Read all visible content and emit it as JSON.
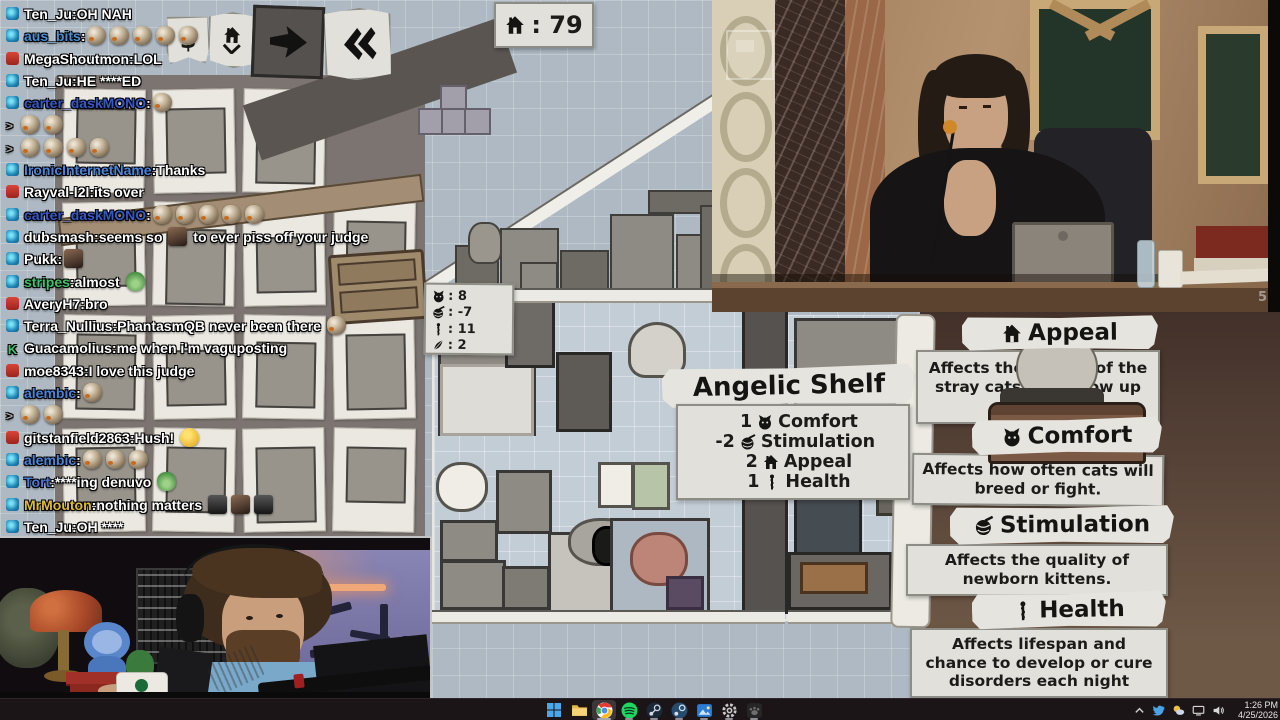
{
  "chat": {
    "continuation_prefix": ">",
    "separator": ":",
    "messages": [
      {
        "badge": "sub",
        "user": "Ten_Ju",
        "color": "#ffffff",
        "parts": [
          {
            "text": "OH NAH"
          }
        ]
      },
      {
        "badge": "sub",
        "user": "aus_bits",
        "color": "#4a90d8",
        "parts": [
          {
            "emote": "bird",
            "count": 5
          }
        ]
      },
      {
        "badge": "mod-red",
        "user": "MegaShoutmon",
        "color": "#ffffff",
        "parts": [
          {
            "text": "LOL"
          }
        ]
      },
      {
        "badge": "sub",
        "user": "Ten_Ju",
        "color": "#ffffff",
        "parts": [
          {
            "text": "HE ****ED"
          }
        ]
      },
      {
        "badge": "sub",
        "user": "carter_daskMONO",
        "color": "#3558c8",
        "parts": [
          {
            "emote": "bird",
            "count": 1
          }
        ]
      },
      {
        "cont": true,
        "parts": [
          {
            "emote": "bird",
            "count": 2
          }
        ]
      },
      {
        "cont": true,
        "parts": [
          {
            "emote": "bird",
            "count": 4
          }
        ]
      },
      {
        "badge": "sub",
        "user": "IronicInternetName",
        "color": "#4a85dc",
        "parts": [
          {
            "text": "Thanks"
          }
        ]
      },
      {
        "badge": "mod-red",
        "user": "Rayval-l2l",
        "color": "#ffffff",
        "parts": [
          {
            "text": "its over"
          }
        ]
      },
      {
        "badge": "sub",
        "user": "carter_daskMONO",
        "color": "#3558c8",
        "parts": [
          {
            "emote": "bird",
            "count": 5
          }
        ]
      },
      {
        "badge": "sub",
        "user": "dubsmash",
        "color": "#ffffff",
        "parts": [
          {
            "text": "seems so "
          },
          {
            "emote": "photo",
            "count": 1
          },
          {
            "text": " to ever piss off your judge"
          }
        ]
      },
      {
        "badge": "sub",
        "user": "Pukk",
        "color": "#ffffff",
        "parts": [
          {
            "emote": "photo",
            "count": 1
          }
        ]
      },
      {
        "badge": "sub",
        "user": "stripes",
        "color": "#3bc46a",
        "parts": [
          {
            "text": "almost "
          },
          {
            "emote": "frog",
            "count": 1
          }
        ]
      },
      {
        "badge": "mod-red",
        "user": "AveryH7",
        "color": "#ffffff",
        "parts": [
          {
            "text": "bro"
          }
        ]
      },
      {
        "badge": "sub",
        "user": "Terra_Nullius",
        "color": "#ffffff",
        "parts": [
          {
            "text": "PhantasmQB never been there "
          },
          {
            "emote": "bird",
            "count": 1
          }
        ]
      },
      {
        "badge": "founder",
        "user": "Guacamolius",
        "color": "#ffffff",
        "parts": [
          {
            "text": "me when i'm vaguposting"
          }
        ]
      },
      {
        "badge": "mod-red",
        "user": "moe8343",
        "color": "#ffffff",
        "parts": [
          {
            "text": "I love this judge"
          }
        ]
      },
      {
        "badge": "sub",
        "user": "alembic",
        "color": "#4a85dc",
        "parts": [
          {
            "emote": "bird",
            "count": 1
          }
        ]
      },
      {
        "cont": true,
        "parts": [
          {
            "emote": "bird",
            "count": 2
          }
        ]
      },
      {
        "badge": "mod-red",
        "user": "gitstanfield2863",
        "color": "#ffffff",
        "parts": [
          {
            "text": "Hush! "
          },
          {
            "emote": "hush",
            "count": 1
          }
        ]
      },
      {
        "badge": "sub",
        "user": "alembic",
        "color": "#4a85dc",
        "parts": [
          {
            "emote": "bird",
            "count": 3
          }
        ]
      },
      {
        "badge": "sub",
        "user": "Tort",
        "color": "#4a78d8",
        "parts": [
          {
            "text": "****ing denuvo "
          },
          {
            "emote": "frog",
            "count": 1
          }
        ]
      },
      {
        "badge": "sub",
        "user": "MrMouton",
        "color": "#e0bc30",
        "parts": [
          {
            "text": "nothing matters "
          },
          {
            "emote": "dark",
            "count": 1
          },
          {
            "emote": "photo",
            "count": 1
          },
          {
            "emote": "dark",
            "count": 1
          }
        ]
      },
      {
        "badge": "sub",
        "user": "Ten_Ju",
        "color": "#ffffff",
        "parts": [
          {
            "text": "OH ****"
          }
        ]
      }
    ]
  },
  "game": {
    "appeal_counter": {
      "icon": "house",
      "sep": ":",
      "value": "79"
    },
    "toolbar": [
      {
        "name": "money-button",
        "glyph": "$"
      },
      {
        "name": "house-down-button"
      },
      {
        "name": "fast-forward-button"
      },
      {
        "name": "rewind-button",
        "glyph": "«"
      }
    ],
    "stats_panel": {
      "sep": ":",
      "rows": [
        {
          "icon": "cat",
          "value": "8"
        },
        {
          "icon": "yarn",
          "value": "-7"
        },
        {
          "icon": "health",
          "value": "11"
        },
        {
          "icon": "feather",
          "value": "2"
        }
      ]
    },
    "tooltip": {
      "title": "Angelic Shelf",
      "stats": [
        {
          "value": "1",
          "icon": "cat",
          "label": "Comfort"
        },
        {
          "value": "-2",
          "icon": "yarn",
          "label": "Stimulation"
        },
        {
          "value": "2",
          "icon": "house",
          "label": "Appeal"
        },
        {
          "value": "1",
          "icon": "health",
          "label": "Health"
        }
      ]
    },
    "avatar_label": "MrMouton",
    "info_panels": [
      {
        "icon": "house",
        "title": "Appeal",
        "desc": "Affects the quality of the stray cats that show up each day"
      },
      {
        "icon": "cat",
        "title": "Comfort",
        "desc": "Affects how often cats will breed or fight."
      },
      {
        "icon": "yarn",
        "title": "Stimulation",
        "desc": "Affects the quality of newborn kittens."
      },
      {
        "icon": "health",
        "title": "Health",
        "desc": "Affects lifespan and chance to develop or cure disorders each night"
      }
    ]
  },
  "judge_cam": {
    "watermark": "5"
  },
  "taskbar": {
    "icons": [
      {
        "name": "start"
      },
      {
        "name": "file-explorer"
      },
      {
        "name": "chrome",
        "active": true,
        "running": true
      },
      {
        "name": "spotify",
        "running": true
      },
      {
        "name": "steam",
        "running": true
      },
      {
        "name": "steam-2",
        "running": true
      },
      {
        "name": "photos",
        "running": true
      },
      {
        "name": "settings",
        "running": true
      },
      {
        "name": "paw-app",
        "running": true
      }
    ],
    "tray": {
      "icons": [
        "tray-expand-chevron",
        "twitter",
        "weather",
        "display",
        "speaker"
      ],
      "clock_time": "1:26 PM",
      "clock_date": "4/25/2026"
    }
  }
}
